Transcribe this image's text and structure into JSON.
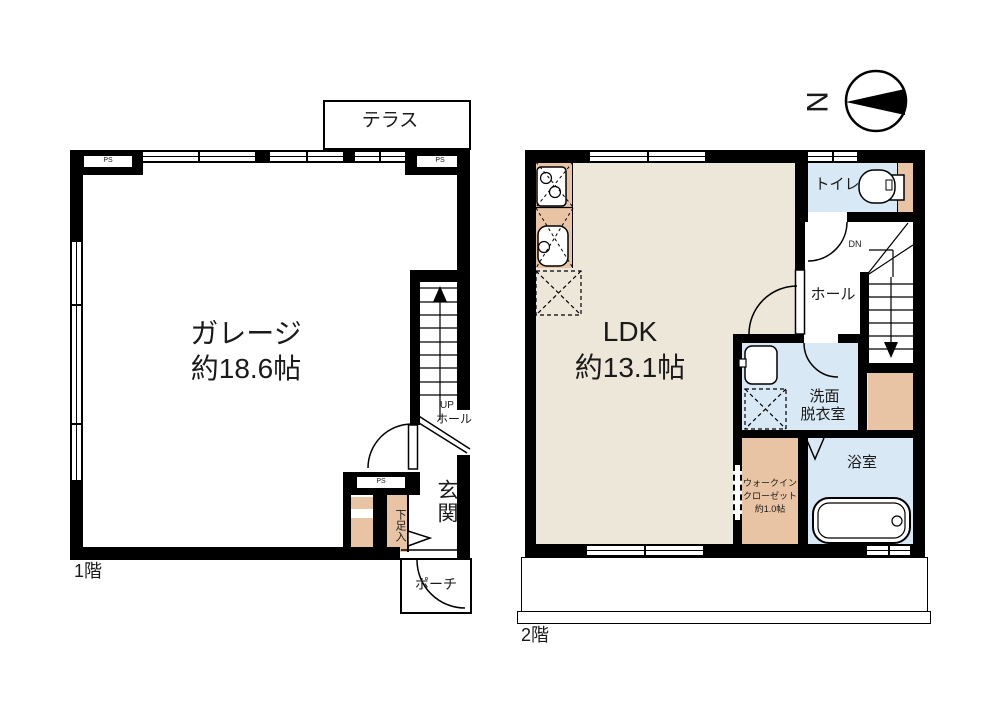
{
  "colors": {
    "wall": "#000000",
    "ldk_floor": "#EDE7DA",
    "wet_area_floor": "#D8E8F4",
    "wood_area_floor": "#E9C4A4"
  },
  "compass": {
    "north_label": "N"
  },
  "floor1": {
    "name": "1階",
    "terrace_label": "テラス",
    "garage_label": "ガレージ",
    "garage_area": "約18.6帖",
    "stairs_up_label": "UP",
    "stairs_hall_label": "ホール",
    "entrance_label": "玄関",
    "shoe_storage_label": "下足入",
    "porch_label": "ポーチ",
    "ps": [
      "PS",
      "PS",
      "PS"
    ]
  },
  "floor2": {
    "name": "2階",
    "ldk_label": "LDK",
    "ldk_area": "約13.1帖",
    "toilet_label": "トイレ",
    "stairs_down_label": "DN",
    "hall_label": "ホール",
    "washroom_label_1": "洗面",
    "washroom_label_2": "脱衣室",
    "bathroom_label": "浴室",
    "wic_label_1": "ウォークイン",
    "wic_label_2": "クローゼット",
    "wic_area": "約1.0帖"
  }
}
